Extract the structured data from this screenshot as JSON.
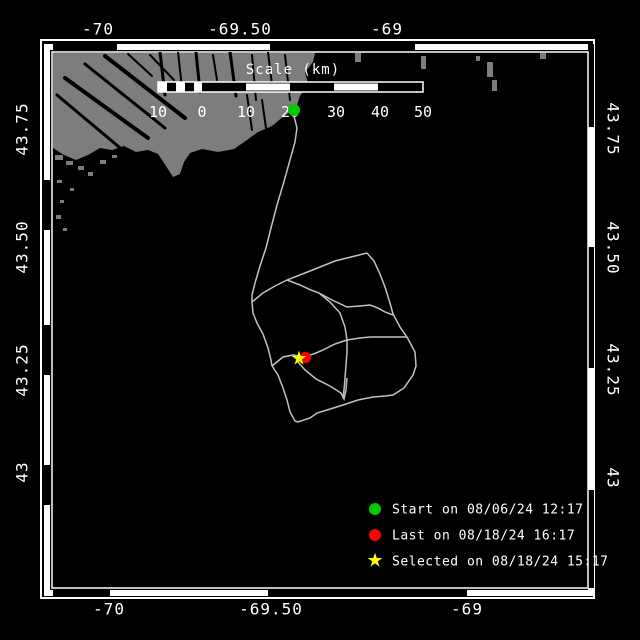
{
  "axes": {
    "top": [
      "-70",
      "-69.50",
      "-69"
    ],
    "bottom": [
      "-70",
      "-69.50",
      "-69"
    ],
    "left": [
      "43.75",
      "43.50",
      "43.25",
      "43"
    ],
    "right": [
      "43.75",
      "43.50",
      "43.25",
      "43"
    ]
  },
  "scale_bar": {
    "title": "Scale (km)",
    "tick_labels": [
      "10",
      "0",
      "10",
      "20",
      "30",
      "40",
      "50"
    ]
  },
  "legend": {
    "items": [
      {
        "marker": "green-circle",
        "color": "#00cc00",
        "label": "Start on 08/06/24 12:17"
      },
      {
        "marker": "red-circle",
        "color": "#fe0000",
        "label": "Last on 08/18/24 16:17"
      },
      {
        "marker": "yellow-star",
        "color": "#ffff00",
        "label": "Selected on 08/18/24 15:17"
      }
    ]
  },
  "colors": {
    "background": "#000000",
    "water": "#000000",
    "land": "#7d7d7d",
    "land_shadow": "#000000",
    "track": "#c2c2c2",
    "frame": "#ffffff",
    "start_marker": "#00cc00",
    "last_marker": "#fe0000",
    "selected_marker": "#ffff00"
  },
  "track_paths": [
    "294,116 297,128 295,142 290,160 283,185 277,205 271,228 266,248 260,266 255,283 252,295 252,302",
    "252,302 263,293 275,286 287,280 310,271 335,261 355,256 367,253",
    "252,302 253,313 257,323 263,334 268,348 271,360 272,366",
    "272,366 278,375 283,388 287,400 290,412 295,421 298,422 310,418 317,413 327,410 343,405 358,400 373,397 385,396 393,395 404,388 413,375 416,366 415,352 407,337 400,327 393,314 390,303 385,287 380,274 374,261 367,253",
    "272,366 283,357 293,355 305,357 316,353 323,350 335,344 347,340 360,338 370,337 383,337 395,337 407,337",
    "287,280 300,285 311,290 319,293 330,302 340,313 345,327 347,340 347,352 346,365 345,378 344,390 343,398",
    "319,293 332,300 347,307 360,306 370,305 378,308 385,312 393,315",
    "298,362 305,370 316,379 330,386 341,393 344,399 346,390 347,378"
  ]
}
